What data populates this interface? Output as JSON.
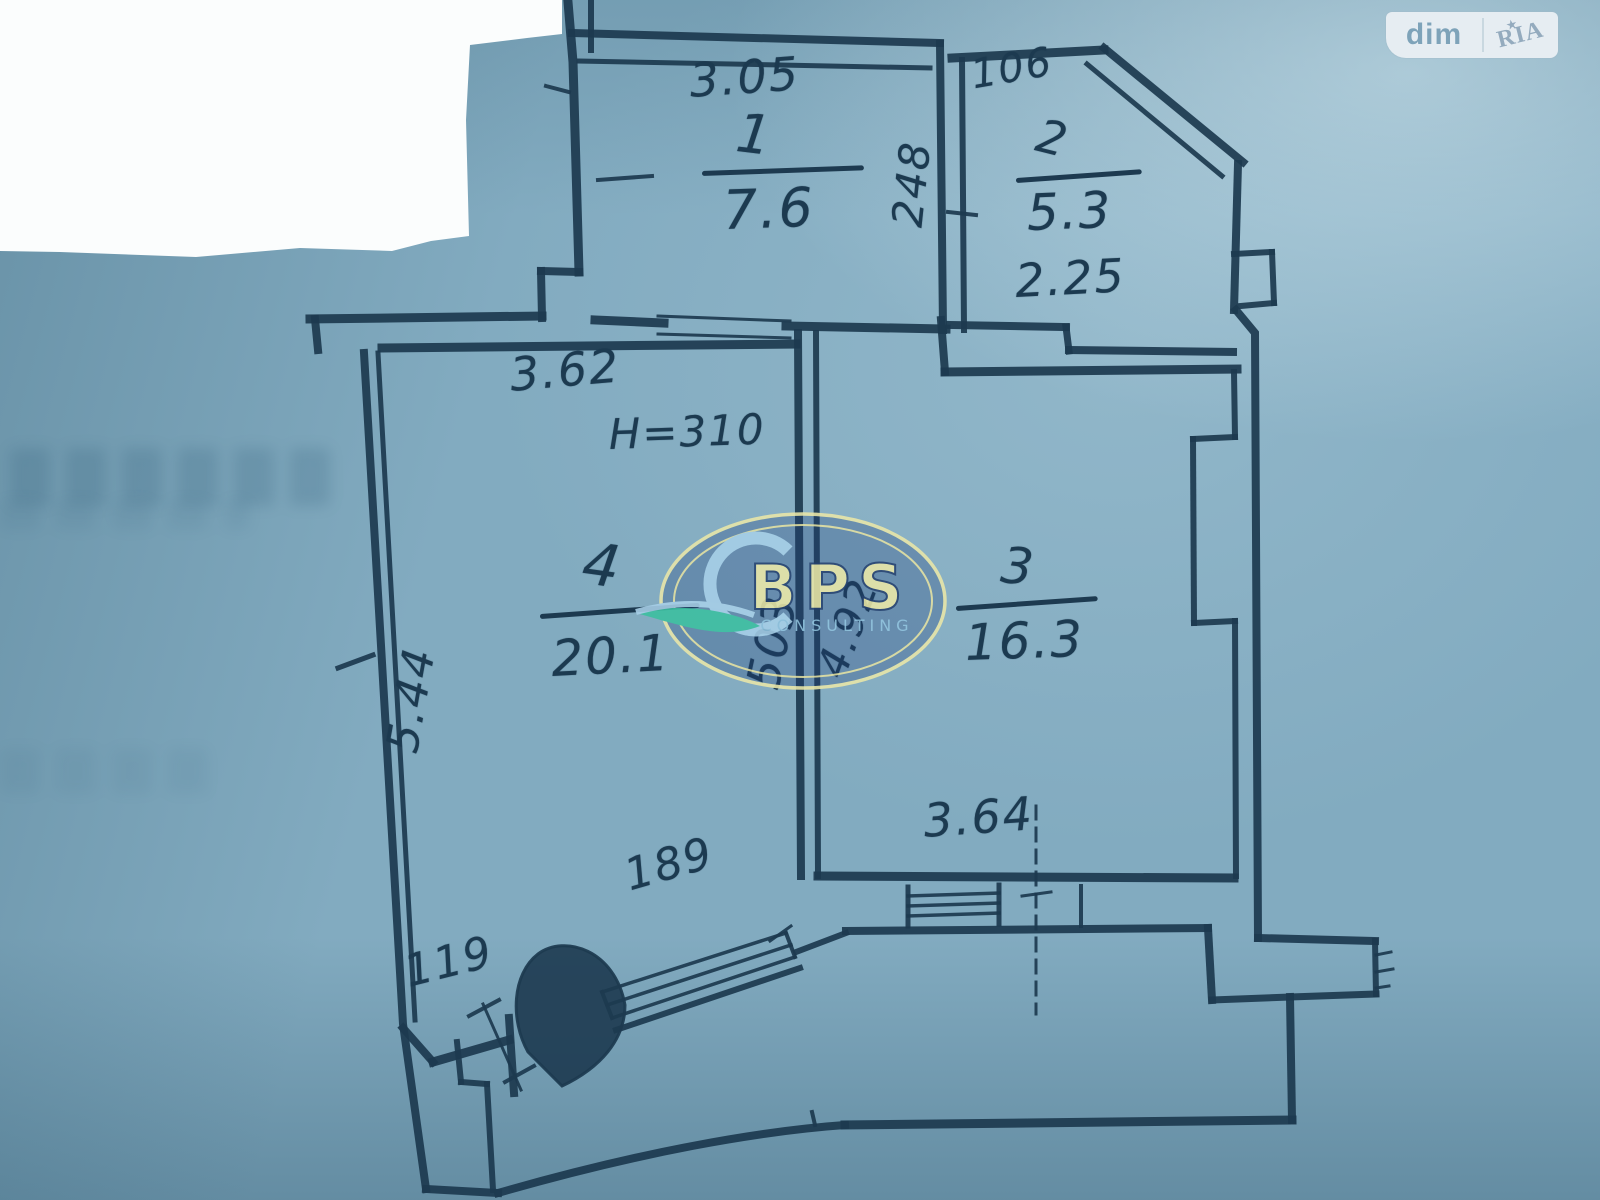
{
  "brand": {
    "dim": "dim",
    "ria": "RIA",
    "ria_star": "★",
    "bps": "BPS",
    "bps_sub": "CONSULTING"
  },
  "plan": {
    "rooms": [
      {
        "number": "1",
        "area": "7.6",
        "width": "3.05"
      },
      {
        "number": "2",
        "area": "5.3",
        "width": "2.25",
        "top_label": "106"
      },
      {
        "number": "3",
        "area": "16.3",
        "width": "3.64",
        "depth": "4.92"
      },
      {
        "number": "4",
        "area": "20.1",
        "width": "3.62",
        "depth": "5.44",
        "ceiling": "H=310"
      }
    ],
    "wall_dims": {
      "rooms_1_2_wall": "248",
      "divider_wall": "503",
      "balcony_door": "119",
      "balcony_window": "189"
    }
  }
}
